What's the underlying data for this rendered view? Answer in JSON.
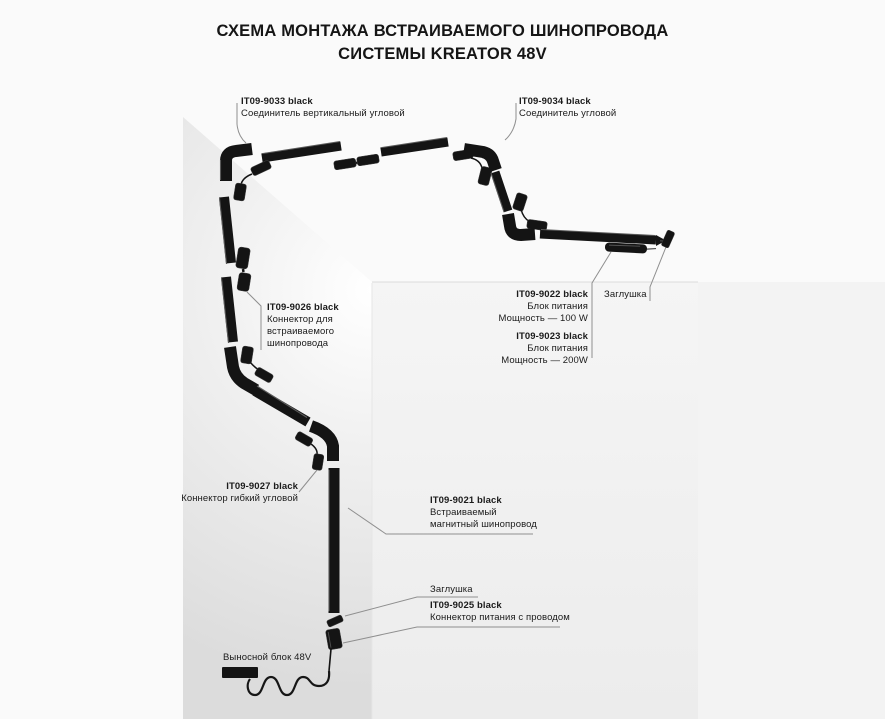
{
  "title": {
    "line1": "СХЕМА МОНТАЖА ВСТРАИВАЕМОГО ШИНОПРОВОДА",
    "line2": "СИСТЕМЫ KREATOR 48V"
  },
  "labels": {
    "corner_vertical": {
      "code": "IT09-9033 black",
      "desc": "Соединитель вертикальный угловой"
    },
    "corner": {
      "code": "IT09-9034 black",
      "desc": "Соединитель угловой"
    },
    "recessed_connector": {
      "code": "IT09-9026 black",
      "desc1": "Коннектор для",
      "desc2": "встраиваемого",
      "desc3": "шинопровода"
    },
    "psu_100": {
      "code": "IT09-9022 black",
      "desc1": "Блок питания",
      "desc2": "Мощность — 100 W"
    },
    "psu_200": {
      "code": "IT09-9023 black",
      "desc1": "Блок питания",
      "desc2": "Мощность — 200W"
    },
    "endcap_top": {
      "text": "Заглушка"
    },
    "flex_connector": {
      "code": "IT09-9027 black",
      "desc": "Коннектор гибкий угловой"
    },
    "track": {
      "code": "IT09-9021 black",
      "desc1": "Встраиваемый",
      "desc2": "магнитный шинопровод"
    },
    "endcap_bottom": {
      "text": "Заглушка"
    },
    "power_connector": {
      "code": "IT09-9025 black",
      "desc": "Коннектор питания с проводом"
    },
    "remote_block": {
      "text": "Выносной блок 48V"
    }
  },
  "colors": {
    "track": "#141414",
    "track-highlight": "#5a5a5a",
    "leader": "#8f8f8f",
    "text": "#1b1b1b",
    "bg": "#fafafa"
  }
}
